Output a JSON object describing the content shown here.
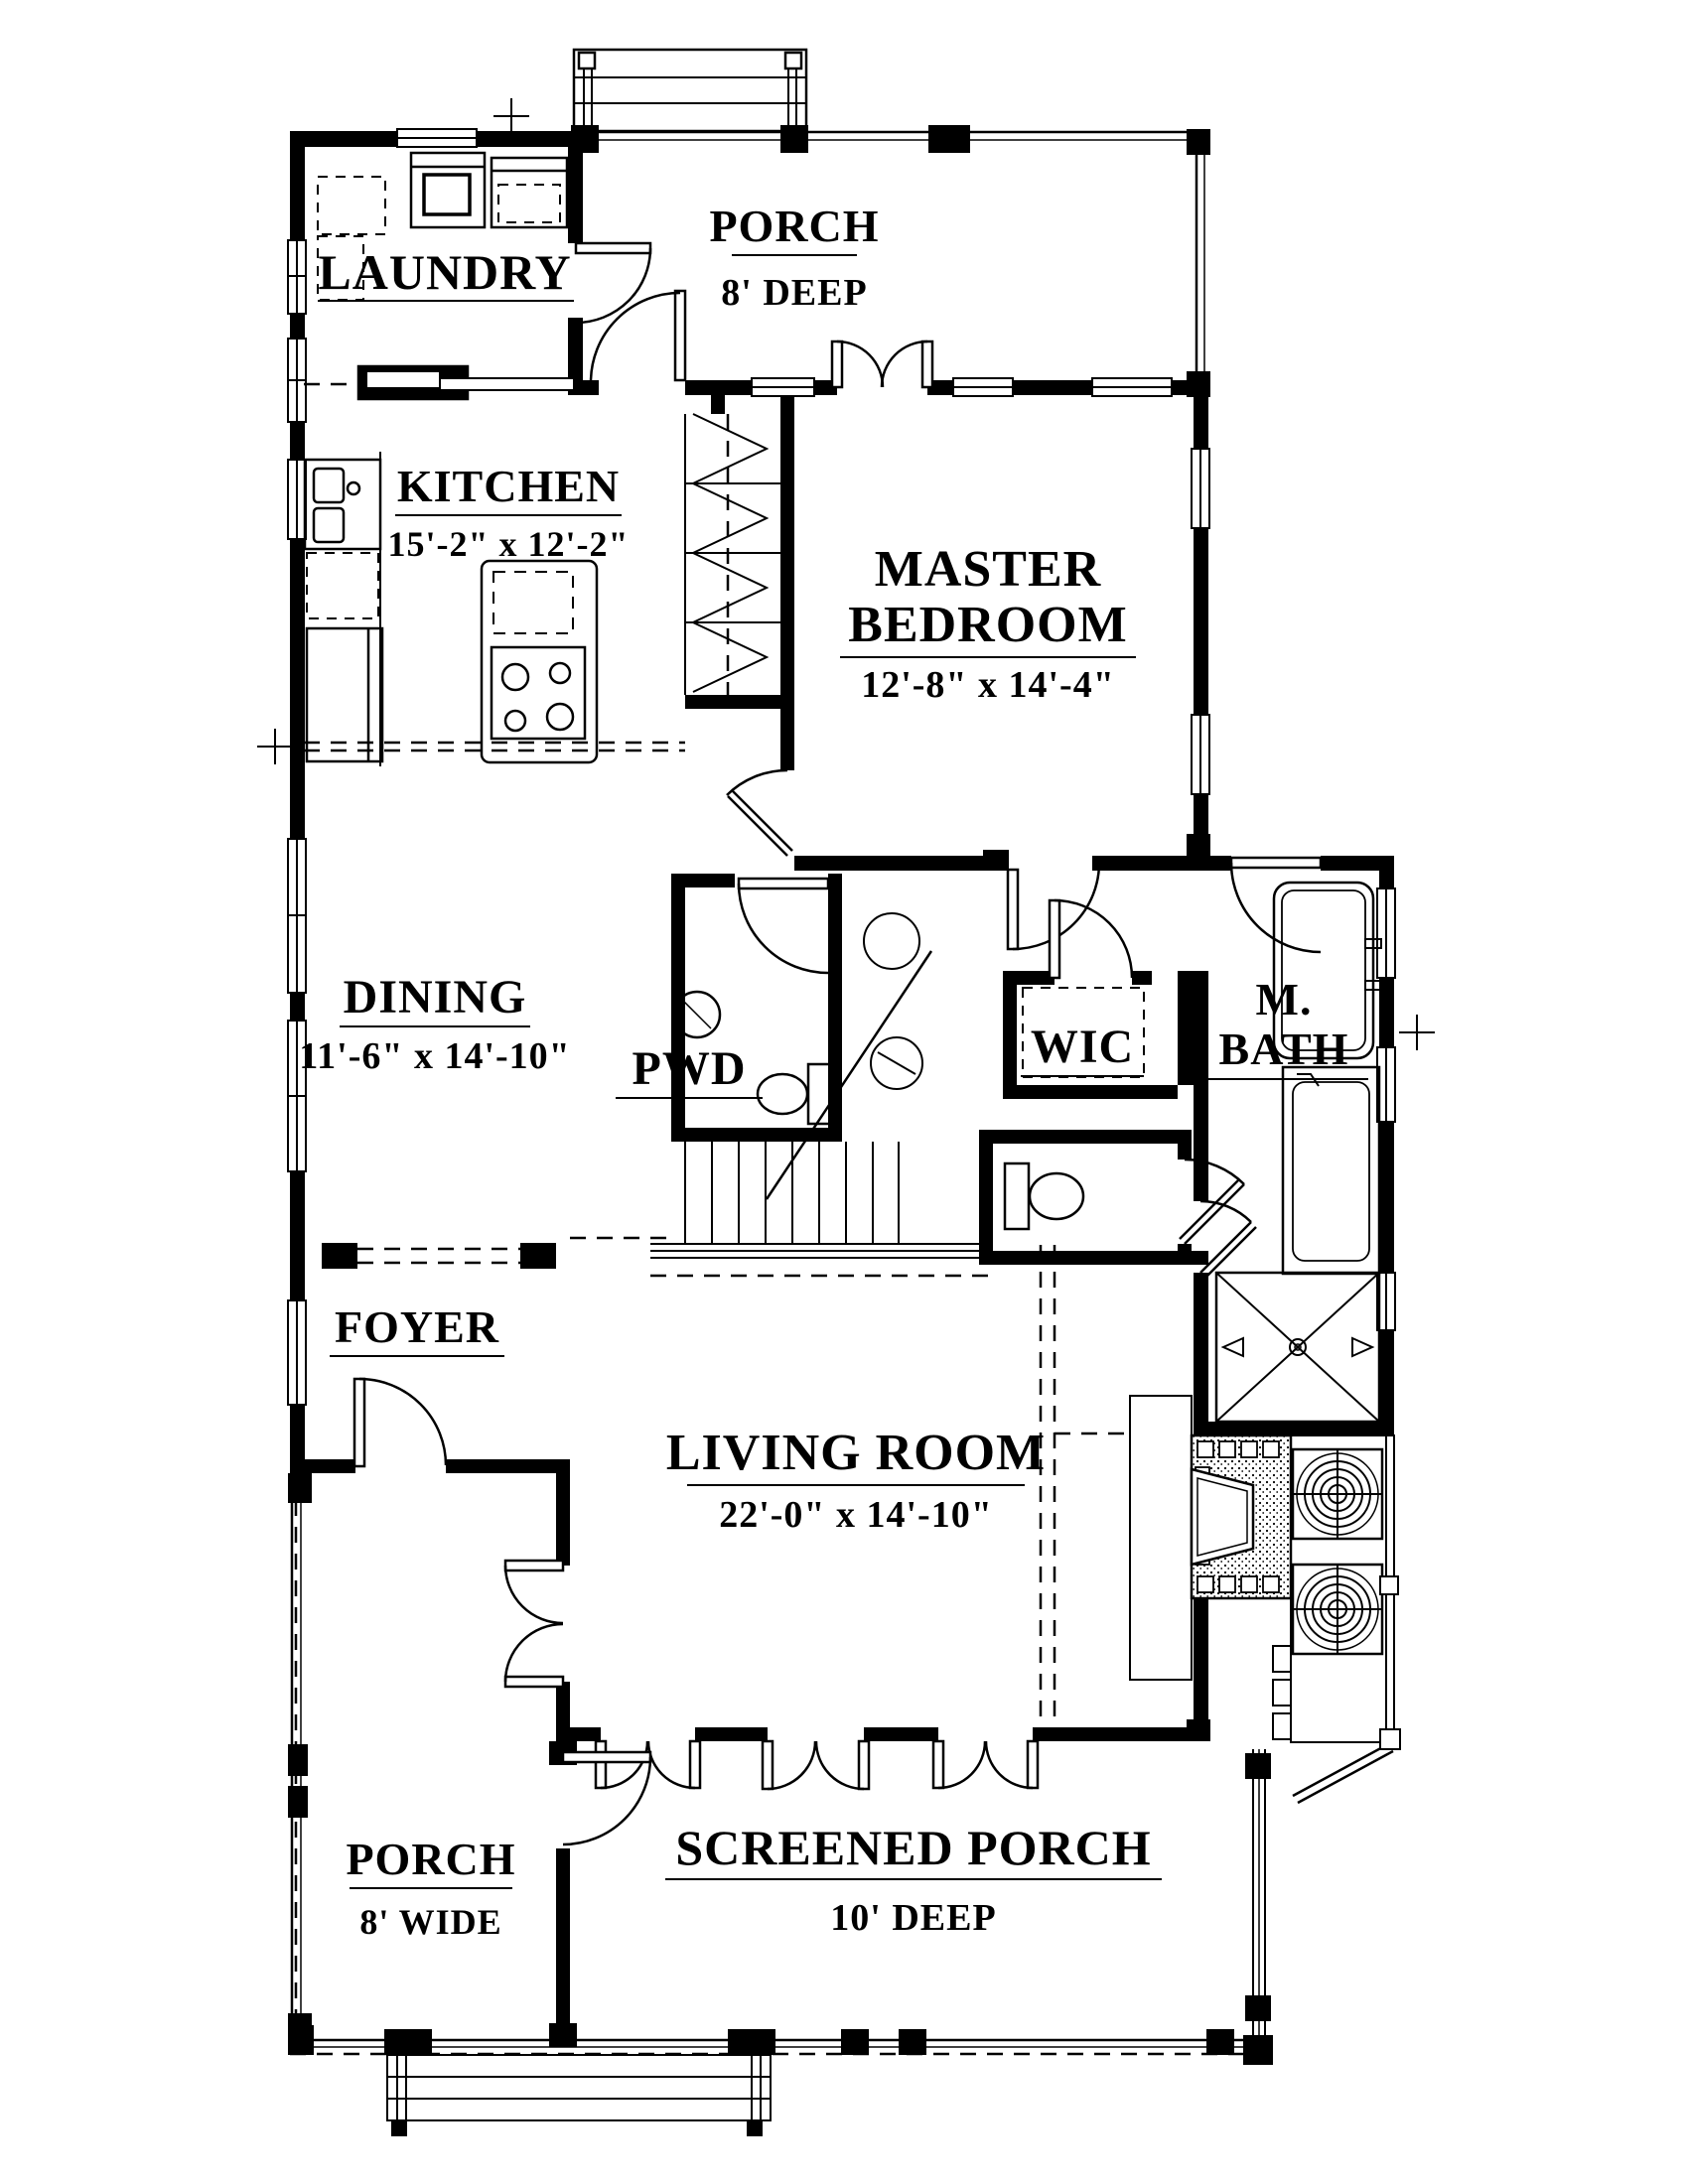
{
  "page": {
    "kind": "architectural-floor-plan",
    "paper_color": "#ffffff",
    "ink_color": "#000000"
  },
  "rooms": {
    "laundry": {
      "name": "LAUNDRY"
    },
    "porch_top": {
      "name": "PORCH",
      "dims": "8' DEEP"
    },
    "kitchen": {
      "name": "KITCHEN",
      "dims": "15'-2\" x 12'-2\""
    },
    "master_bedroom": {
      "name_line1": "MASTER",
      "name_line2": "BEDROOM",
      "dims": "12'-8\" x 14'-4\""
    },
    "dining": {
      "name": "DINING",
      "dims": "11'-6\" x 14'-10\""
    },
    "powder": {
      "name": "PWD"
    },
    "wic": {
      "name": "WIC"
    },
    "master_bath": {
      "name_line1": "M.",
      "name_line2": "BATH"
    },
    "foyer": {
      "name": "FOYER"
    },
    "living": {
      "name": "LIVING ROOM",
      "dims": "22'-0\" x 14'-10\""
    },
    "porch_left": {
      "name": "PORCH",
      "dims": "8' WIDE"
    },
    "screened_porch": {
      "name": "SCREENED PORCH",
      "dims": "10' DEEP"
    }
  }
}
